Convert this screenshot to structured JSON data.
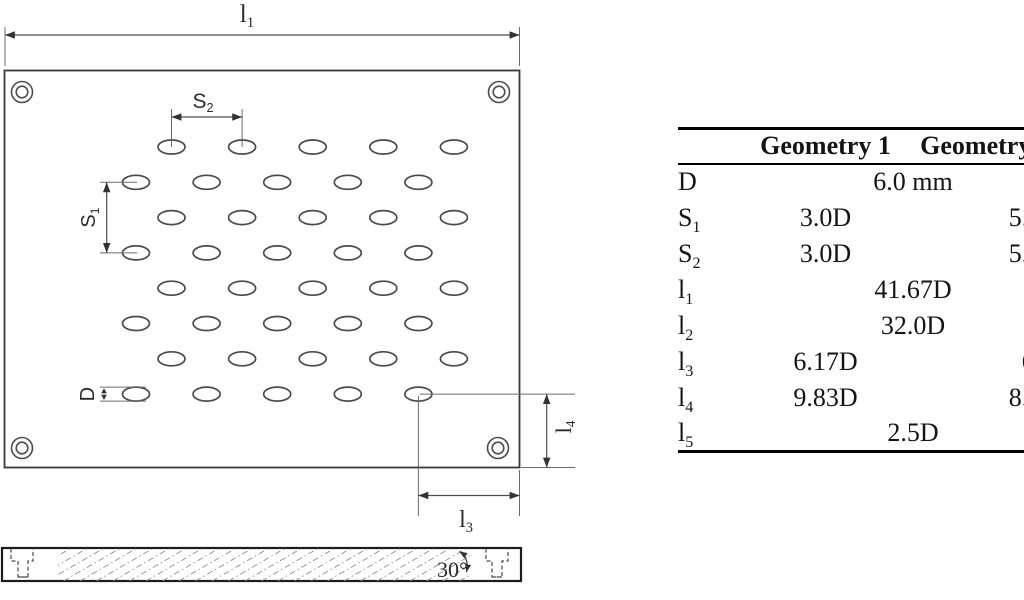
{
  "drawing": {
    "labels": {
      "l1": {
        "base": "l",
        "sub": "1"
      },
      "s2": {
        "base": "S",
        "sub": "2"
      },
      "s1": {
        "base": "S",
        "sub": "1"
      },
      "d": {
        "base": "D",
        "sub": ""
      },
      "l4": {
        "base": "l",
        "sub": "4"
      },
      "l3": {
        "base": "l",
        "sub": "3"
      },
      "angle": "30°"
    }
  },
  "table": {
    "headers": {
      "col1": "Geometry 1",
      "col2": "Geometry 2"
    },
    "rows": [
      {
        "param": "D",
        "sub": "",
        "shared": "6.0 mm",
        "geometry1": "",
        "geometry2": ""
      },
      {
        "param": "S",
        "sub": "1",
        "shared": "",
        "geometry1": "3.0D",
        "geometry2": "5.75D"
      },
      {
        "param": "S",
        "sub": "2",
        "shared": "",
        "geometry1": "3.0D",
        "geometry2": "5.75D"
      },
      {
        "param": "l",
        "sub": "1",
        "shared": "41.67D",
        "geometry1": "",
        "geometry2": ""
      },
      {
        "param": "l",
        "sub": "2",
        "shared": "32.0D",
        "geometry1": "",
        "geometry2": ""
      },
      {
        "param": "l",
        "sub": "3",
        "shared": "",
        "geometry1": "6.17D",
        "geometry2": "6.0D"
      },
      {
        "param": "l",
        "sub": "4",
        "shared": "",
        "geometry1": "9.83D",
        "geometry2": "8.17D"
      },
      {
        "param": "l",
        "sub": "5",
        "shared": "2.5D",
        "geometry1": "",
        "geometry2": ""
      }
    ]
  }
}
